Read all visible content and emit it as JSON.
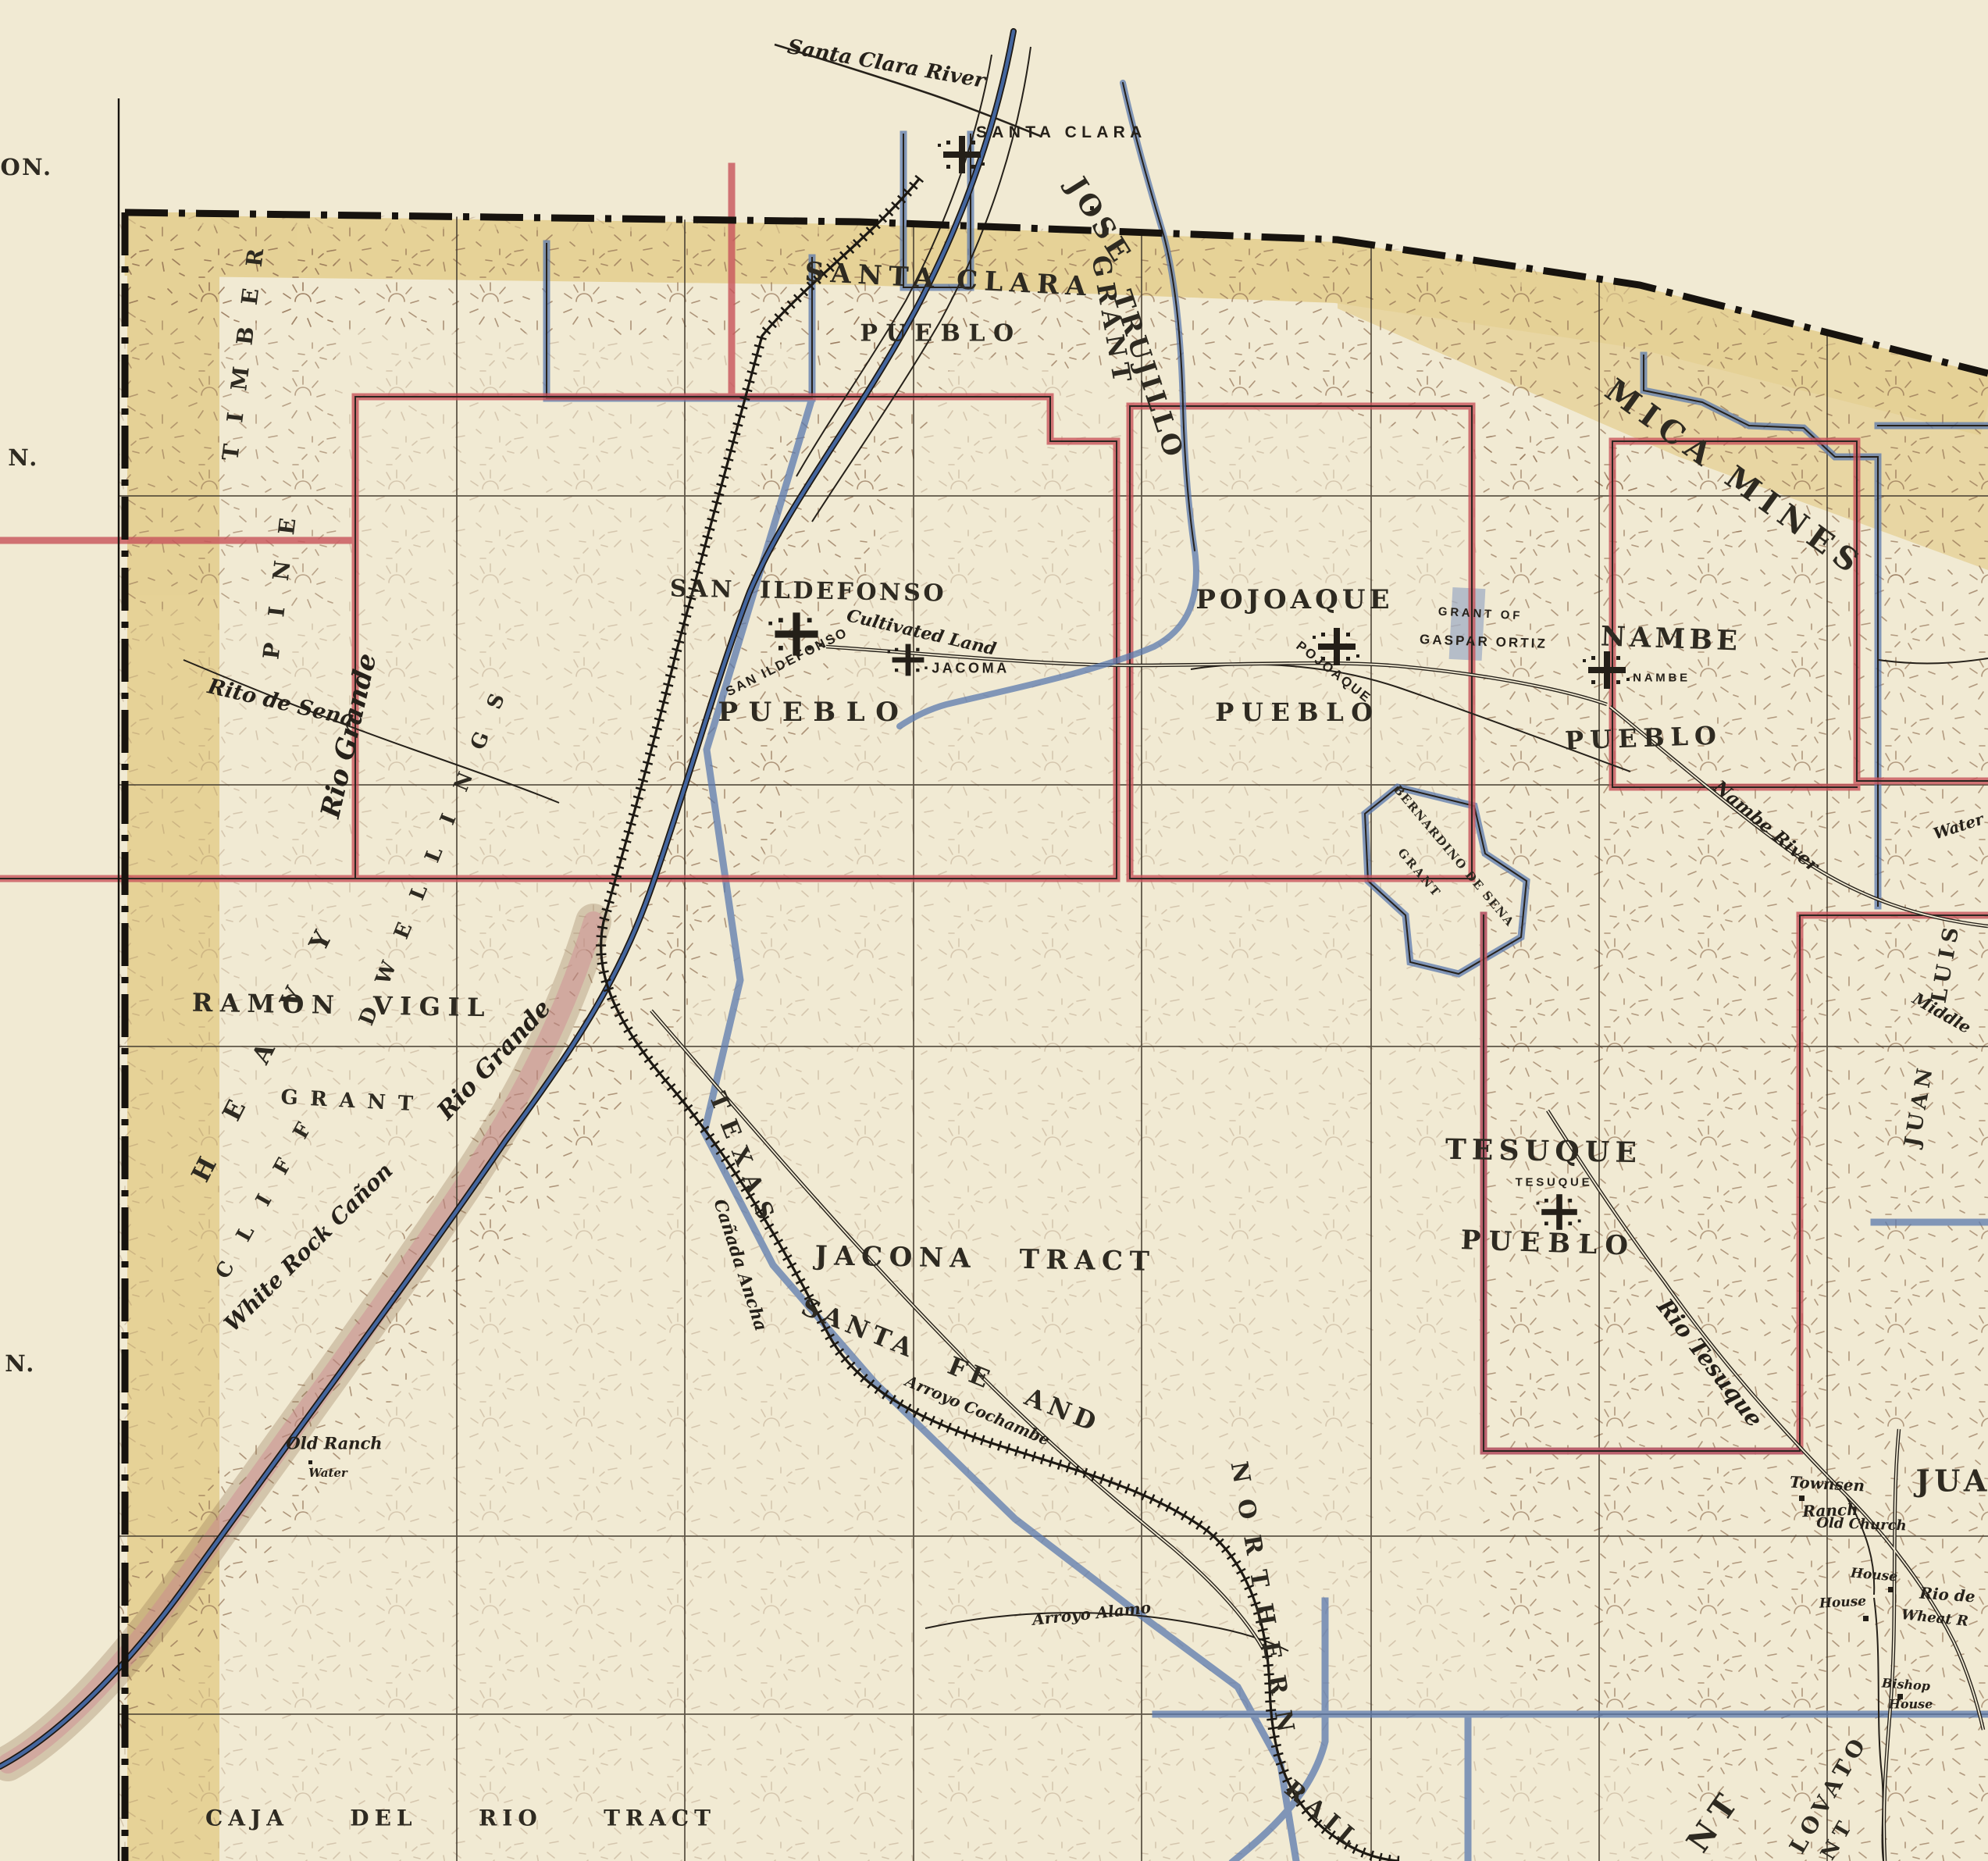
{
  "map_type": "historic-land-grant-survey-map",
  "region": "Pueblo land grants north of Santa Fe, New Mexico",
  "colors": {
    "paper": "#f1ead3",
    "hachure_brown": "#8d6b4e",
    "border_yellow": "#dcbd66",
    "grant_red": "#c8545b",
    "grant_blue": "#5b79ae",
    "river_blue": "#44669f",
    "ink": "#26211a"
  },
  "labels": {
    "santa_clara_river": "Santa Clara River",
    "santa_clara_town": "SANTA CLARA",
    "santa_clara_grant": "SANTA CLARA",
    "sc_pueblo": "PUEBLO",
    "jose": "JOSE",
    "grant_v": "GRANT",
    "trujillo": "TRUJILLO",
    "mica_mines": "MICA MINES",
    "san_ildefonso": "SAN ILDEFONSO",
    "si_town": "SAN ILDEFONSO",
    "cultivated_land": "Cultivated Land",
    "jacoma": "JACOMA",
    "si_pueblo": "PUEBLO",
    "pojoaque": "POJOAQUE",
    "poj_town": "POJOAQUE",
    "poj_pueblo": "PUEBLO",
    "grant_of": "GRANT OF",
    "gaspar_ortiz": "GASPAR ORTIZ",
    "nambe": "NAMBE",
    "nambe_town": "NAMBE",
    "nambe_pueblo": "PUEBLO",
    "nambe_river": "Nambe River",
    "bernardino": "BERNARDINO DE SENA",
    "bern_grant": "GRANT",
    "heavy": "HEAVY",
    "pine": "PINE",
    "timber": "TIMBER",
    "cliff": "CLIFF",
    "dwellings": "DWELLINGS",
    "ramon_vigil": "RAMON VIGIL",
    "rv_grant": "GRANT",
    "rito_de_sena": "Rito de Sena",
    "rio_grande_a": "Rio Grande",
    "rio_grande_b": "Rio Grande",
    "white_rock_canon": "White Rock Cañon",
    "old_ranch": "Old Ranch",
    "old_ranch_water": "Water",
    "caja_del_rio": "CAJA DEL RIO TRACT",
    "jacona_tract": "JACONA TRACT",
    "texas": "TEXAS",
    "canada_ancha": "Cañada Ancha",
    "santa_fe_and": "SANTA FE AND",
    "arroyo_cochambe": "Arroyo Cochambe",
    "northern": "NORTHERN",
    "rail": "RAIL",
    "tesuque": "TESUQUE",
    "tesuque_town": "TESUQUE",
    "tesuque_pueblo": "PUEBLO",
    "rio_tesuque": "Rio Tesuque",
    "townsen": "Townsen",
    "ranch": "Ranch",
    "old_church": "Old Church",
    "house_a": "House",
    "house_b": "House",
    "rio_de": "Rio de",
    "wheat": "Wheat R",
    "bishop": "Bishop",
    "bishop_house": "House",
    "lovato": "LOVATO",
    "lovato_grant": "GRANT",
    "nt_fragment": "NT",
    "juan_big": "JUAN",
    "luis_edge": "LUIS",
    "juan_edge": "JUAN",
    "middle": "Middle",
    "water_edge": "Water",
    "arroyo_alamo": "Arroyo Alamo",
    "margin_on": "ON.",
    "margin_n1": "N.",
    "margin_n2": "N."
  }
}
